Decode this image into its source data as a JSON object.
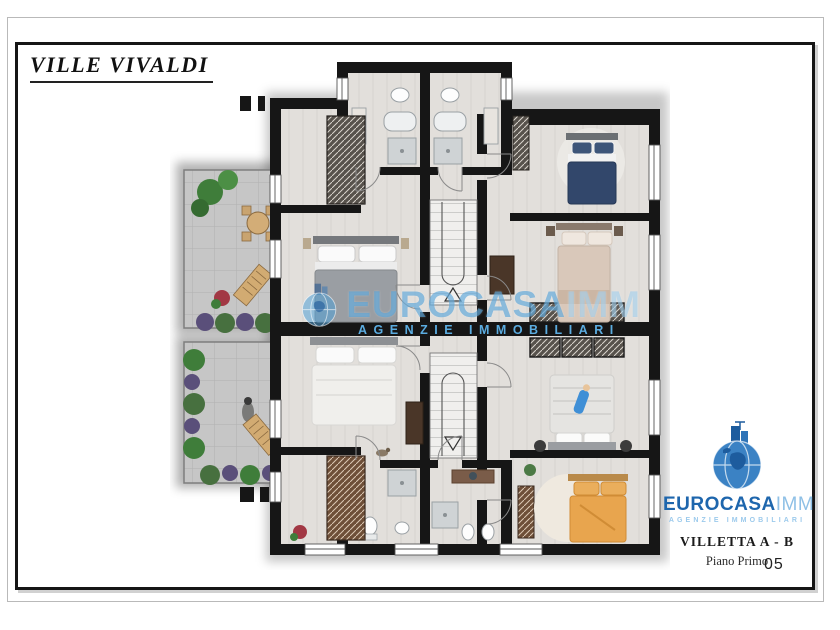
{
  "page": {
    "title": "VILLE VIVALDI",
    "page_number": "05"
  },
  "watermark": {
    "brand": "EUROCASA",
    "brand_suffix": "IMM",
    "tagline": "AGENZIE IMMOBILIARI"
  },
  "logo": {
    "brand": "EUROCASA",
    "brand_suffix": "IMM",
    "tagline": "AGENZIE IMMOBILIARI",
    "unit_label": "VILLETTA  A - B",
    "floor_label": "Piano Primo"
  },
  "colors": {
    "wall": "#161616",
    "floor": "#e2dfdb",
    "terrace": "#c6c6c6",
    "brand_blue": "#1e66ad",
    "brand_light_blue": "#8fc0e6",
    "watermark_blue": "#50a0d7",
    "bed_navy": "#32476b",
    "bed_beige": "#d9c8ba",
    "bed_gray": "#9a9ea3",
    "bed_white": "#f0efec",
    "bed_orange": "#e8a54e"
  },
  "floor_plan": {
    "type": "residential-floor-plan",
    "units": [
      "A",
      "B"
    ],
    "staircase_count": 2,
    "bathroom_count": 4,
    "bed_count": 6,
    "terrace_count": 2,
    "bed_colors": [
      "gray",
      "navy-blue",
      "beige",
      "white",
      "white-gray",
      "orange"
    ]
  }
}
